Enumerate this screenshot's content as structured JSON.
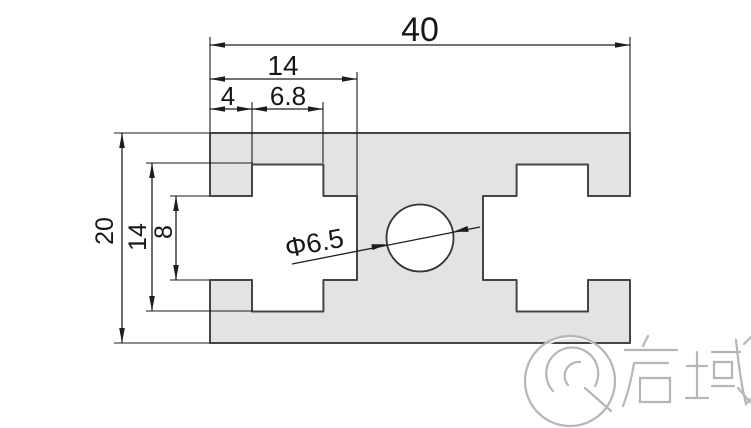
{
  "drawing": {
    "dims": {
      "total_width": "40",
      "slot_total_depth": "14",
      "mouth_depth": "4",
      "cavity_width": "6.8",
      "total_height": "20",
      "cavity_height": "14",
      "mouth_height": "8",
      "hole_diameter": "Φ6.5"
    },
    "watermark": {
      "brand_text": "启域"
    },
    "colors": {
      "profile_fill": "#e3e3e3",
      "profile_outline": "#454545",
      "dimension_ink": "#1d1d1d",
      "watermark_gray": "#b6b6b6"
    }
  }
}
